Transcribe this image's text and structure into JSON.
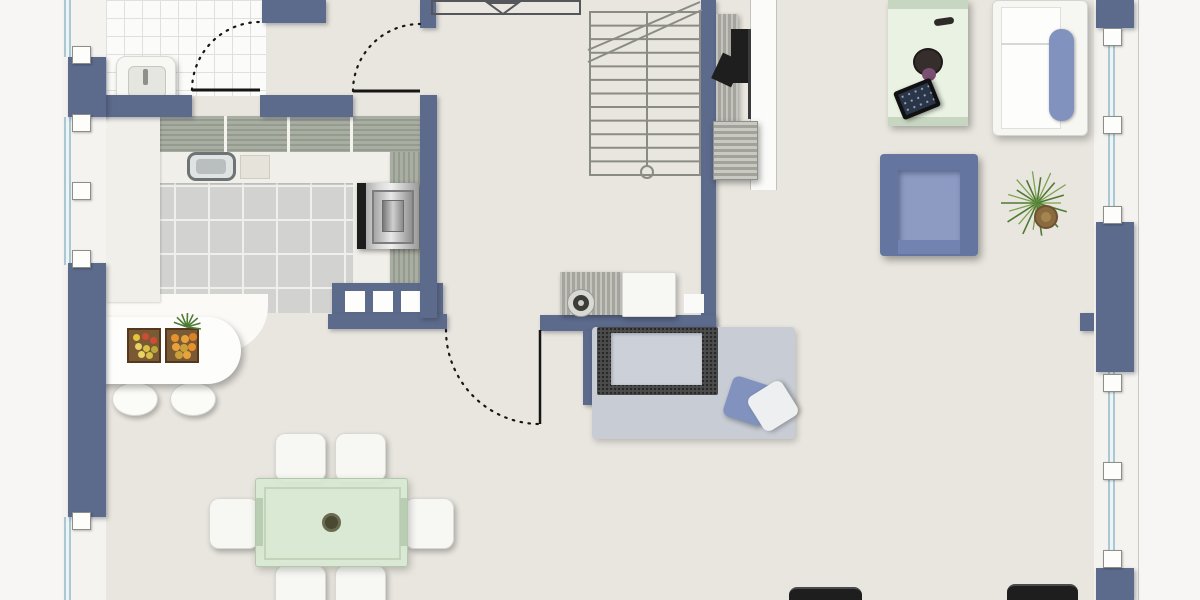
{
  "title": "Apartment ground-floor plan",
  "colors": {
    "wall": "#5c6a8c",
    "floor": "#e9e6df",
    "outside": "#f7f6f4",
    "frame": "#f4f3f0",
    "glass": "#a9c8d2",
    "wc_tile": "#fbfbf9",
    "wc_grout": "#e0e0dc",
    "kitchen_tile": "#d2d2d0",
    "kitchen_grout": "#efefec",
    "counter": "#a9aea3",
    "counter_stripe": "#969b90",
    "worktop": "#f0efe9",
    "white_furniture": "#f7f7f4",
    "table_green": "#d8e7d3",
    "table_frame": "#c2d5bb",
    "upholstery_blue": "#8092bd",
    "armchair_blue": "#64759f",
    "armchair_seat": "#8d9bc3",
    "rug": "#c7ccd5",
    "dark_object": "#1e1e1e",
    "linework": "#8b8b85",
    "door_line": "#161616",
    "desk_green": "#e9f2e3",
    "desk_band": "#c6d6c0",
    "plant_green": "#4e7a34"
  },
  "rooms": {
    "wc": "WC",
    "hall": "hallway",
    "kitchen": "kitchen",
    "dining": "dining area",
    "living": "living room",
    "stairs": "staircase"
  },
  "furniture": {
    "wc_sink": "WC hand basin",
    "kitchen_counter": "kitchen counter",
    "kitchen_sink": "kitchen sink",
    "cutting_board": "cutting board",
    "oven": "built-in oven",
    "half_wall": "kitchen half wall with posts",
    "island": "breakfast-bar island",
    "fruit_crate_1": "fruit crate (bananas, tomatoes)",
    "fruit_crate_2": "fruit crate (oranges, pineapple)",
    "bar_stool": "bar stool",
    "dining_table": "glass dining table",
    "dining_chair": "dining chair",
    "stairs": "staircase to upper floor",
    "tv": "wall-mounted TV",
    "tv_board": "media sideboard",
    "tv_cabinet": "media cabinet",
    "sideboard": "sideboard with speaker",
    "rug": "area rug",
    "daybed": "daybed / lounge mat",
    "cushion_blue": "blue cushion",
    "cushion_white": "white cushion",
    "desk": "desk with tablet and bowl",
    "tablet": "tablet",
    "white_sofa": "white sofa with blue throw",
    "armchair": "armchair",
    "plant": "potted yucca plant",
    "dark_bench": "dark bench"
  }
}
